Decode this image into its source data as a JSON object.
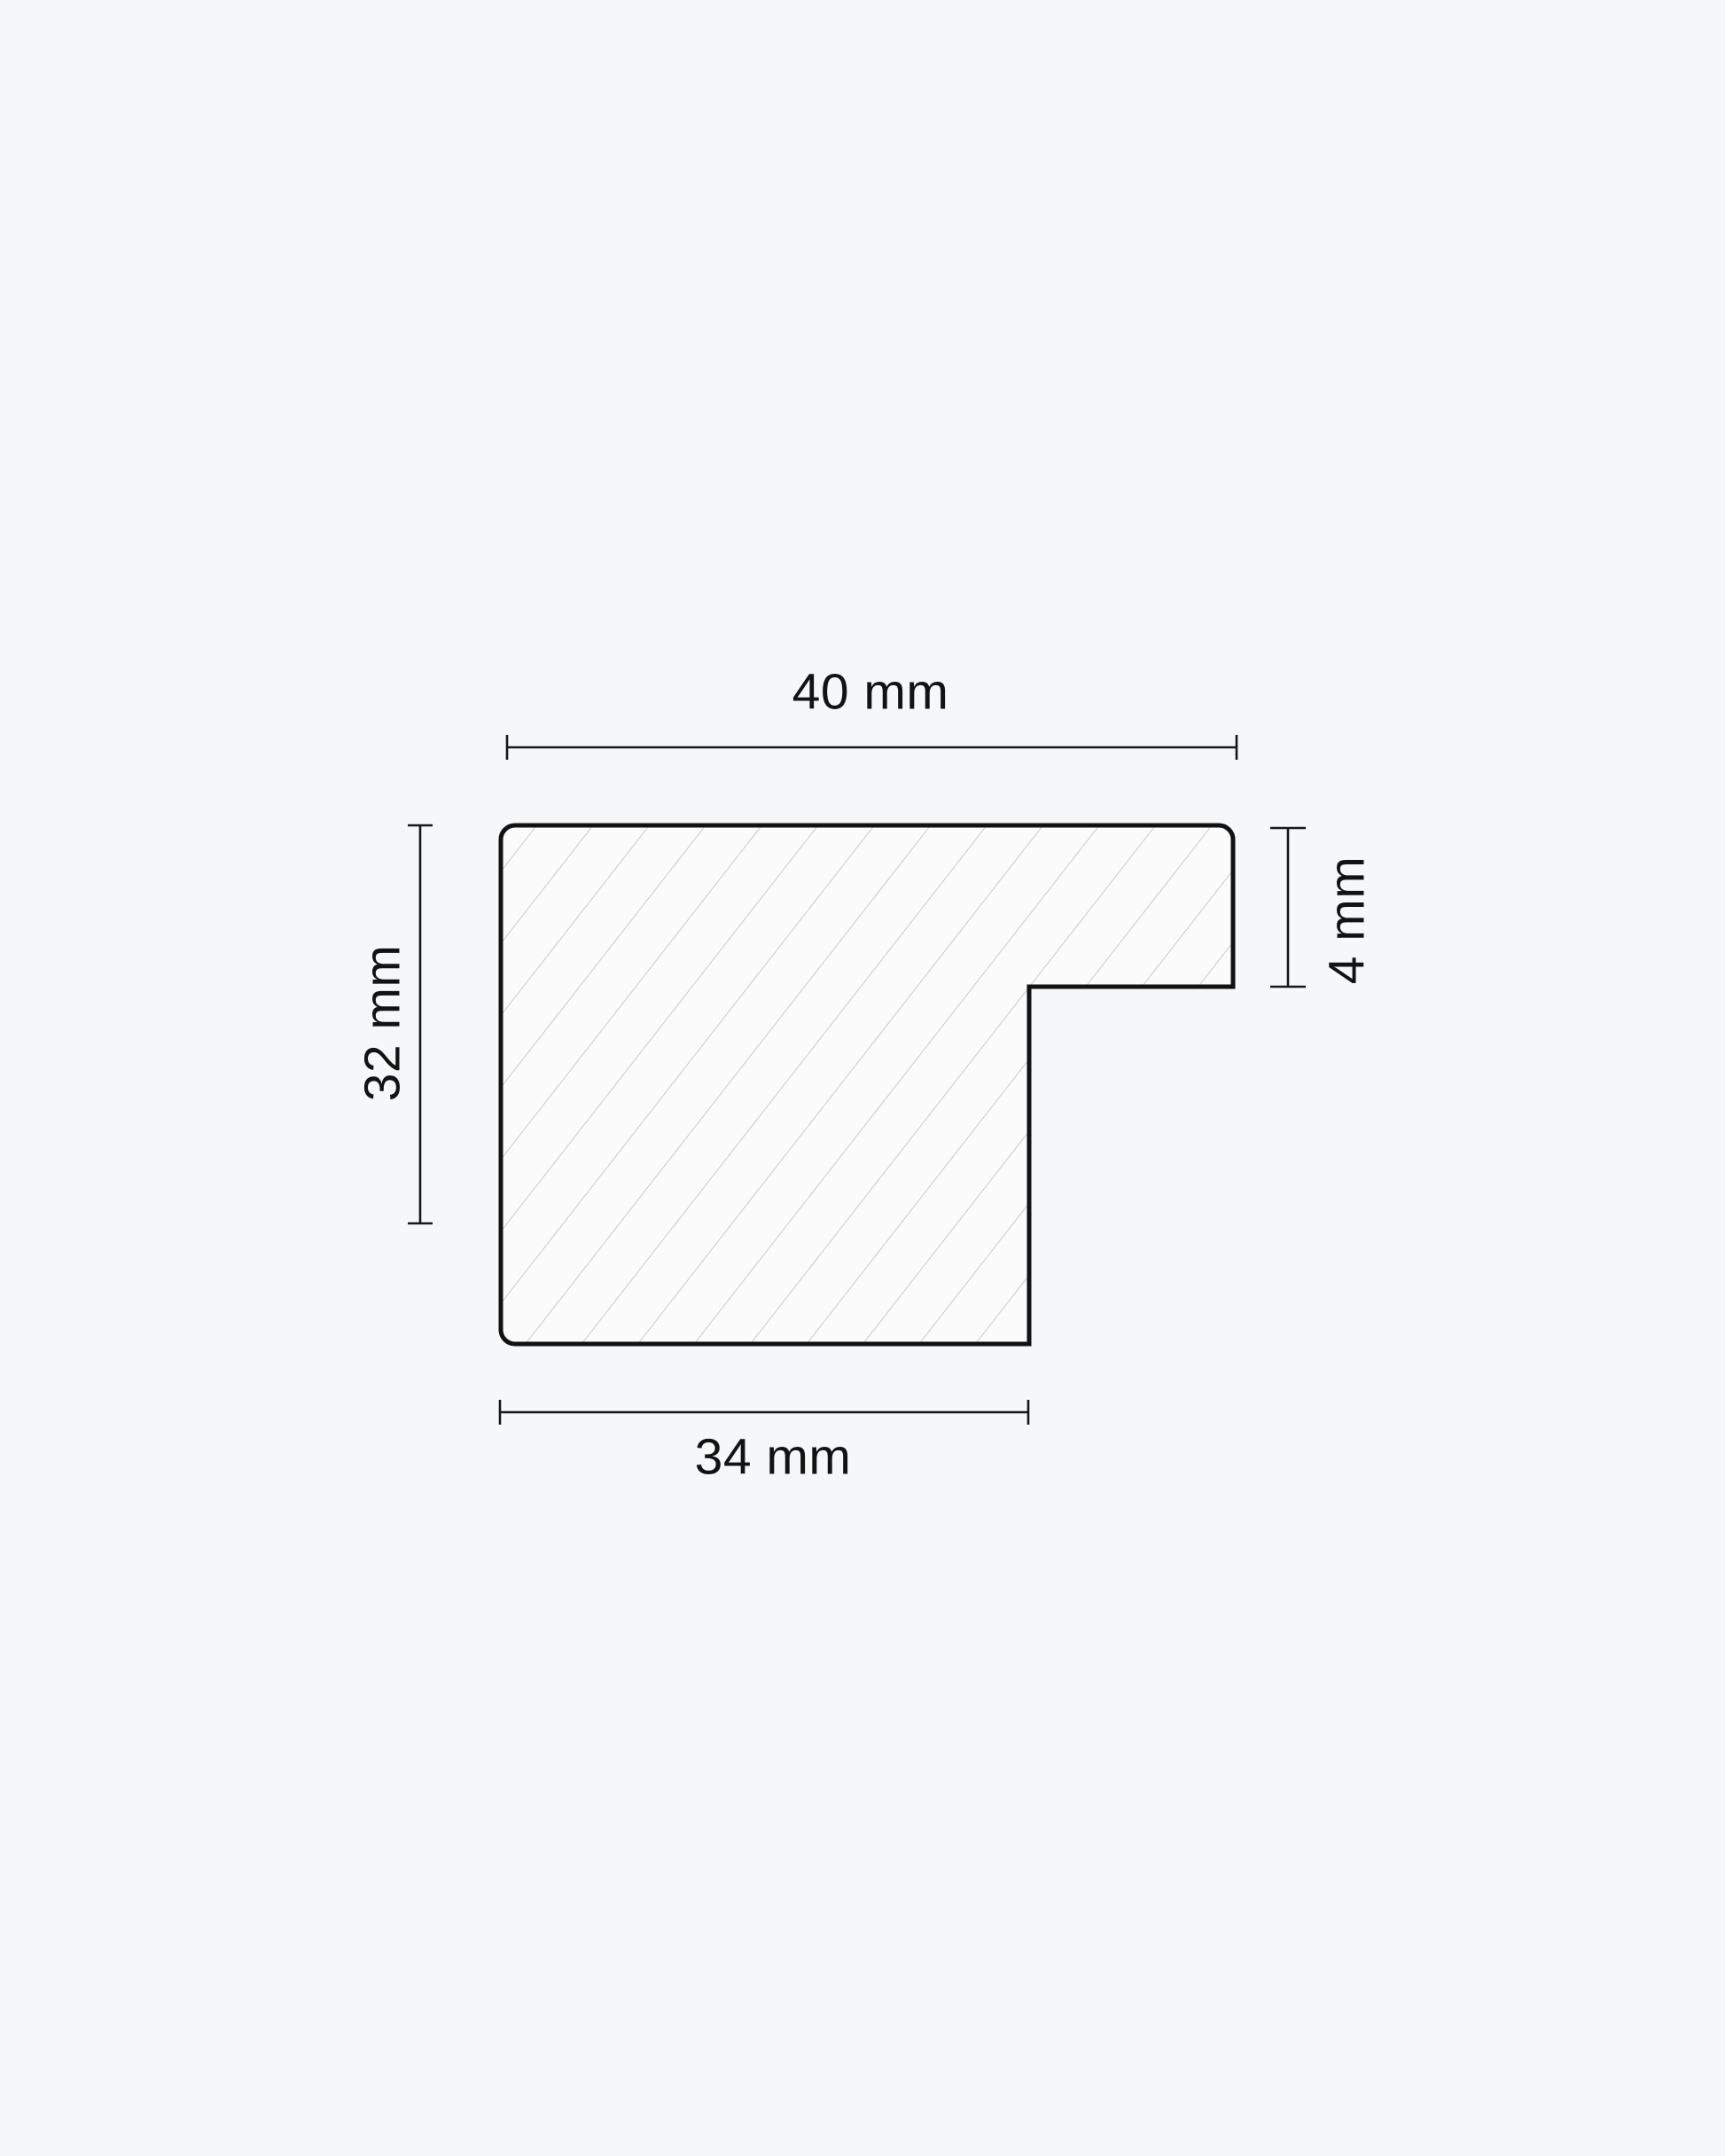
{
  "page": {
    "background": "#f6f7f8"
  },
  "diagram": {
    "kind": "moulding-profile-cross-section",
    "unit": "mm",
    "dimensions": {
      "top_width": {
        "value": 40,
        "label": "40 mm"
      },
      "left_height": {
        "value": 32,
        "label": "32 mm"
      },
      "right_depth": {
        "value": 4,
        "label": "4 mm"
      },
      "bottom_width": {
        "value": 34,
        "label": "34 mm"
      }
    },
    "colors": {
      "outline": "#121212",
      "dimension_lines": "#171717",
      "hatch_lines": "#b9bbc0",
      "shape_fill": "#fbfbfc",
      "text": "#131313"
    }
  }
}
